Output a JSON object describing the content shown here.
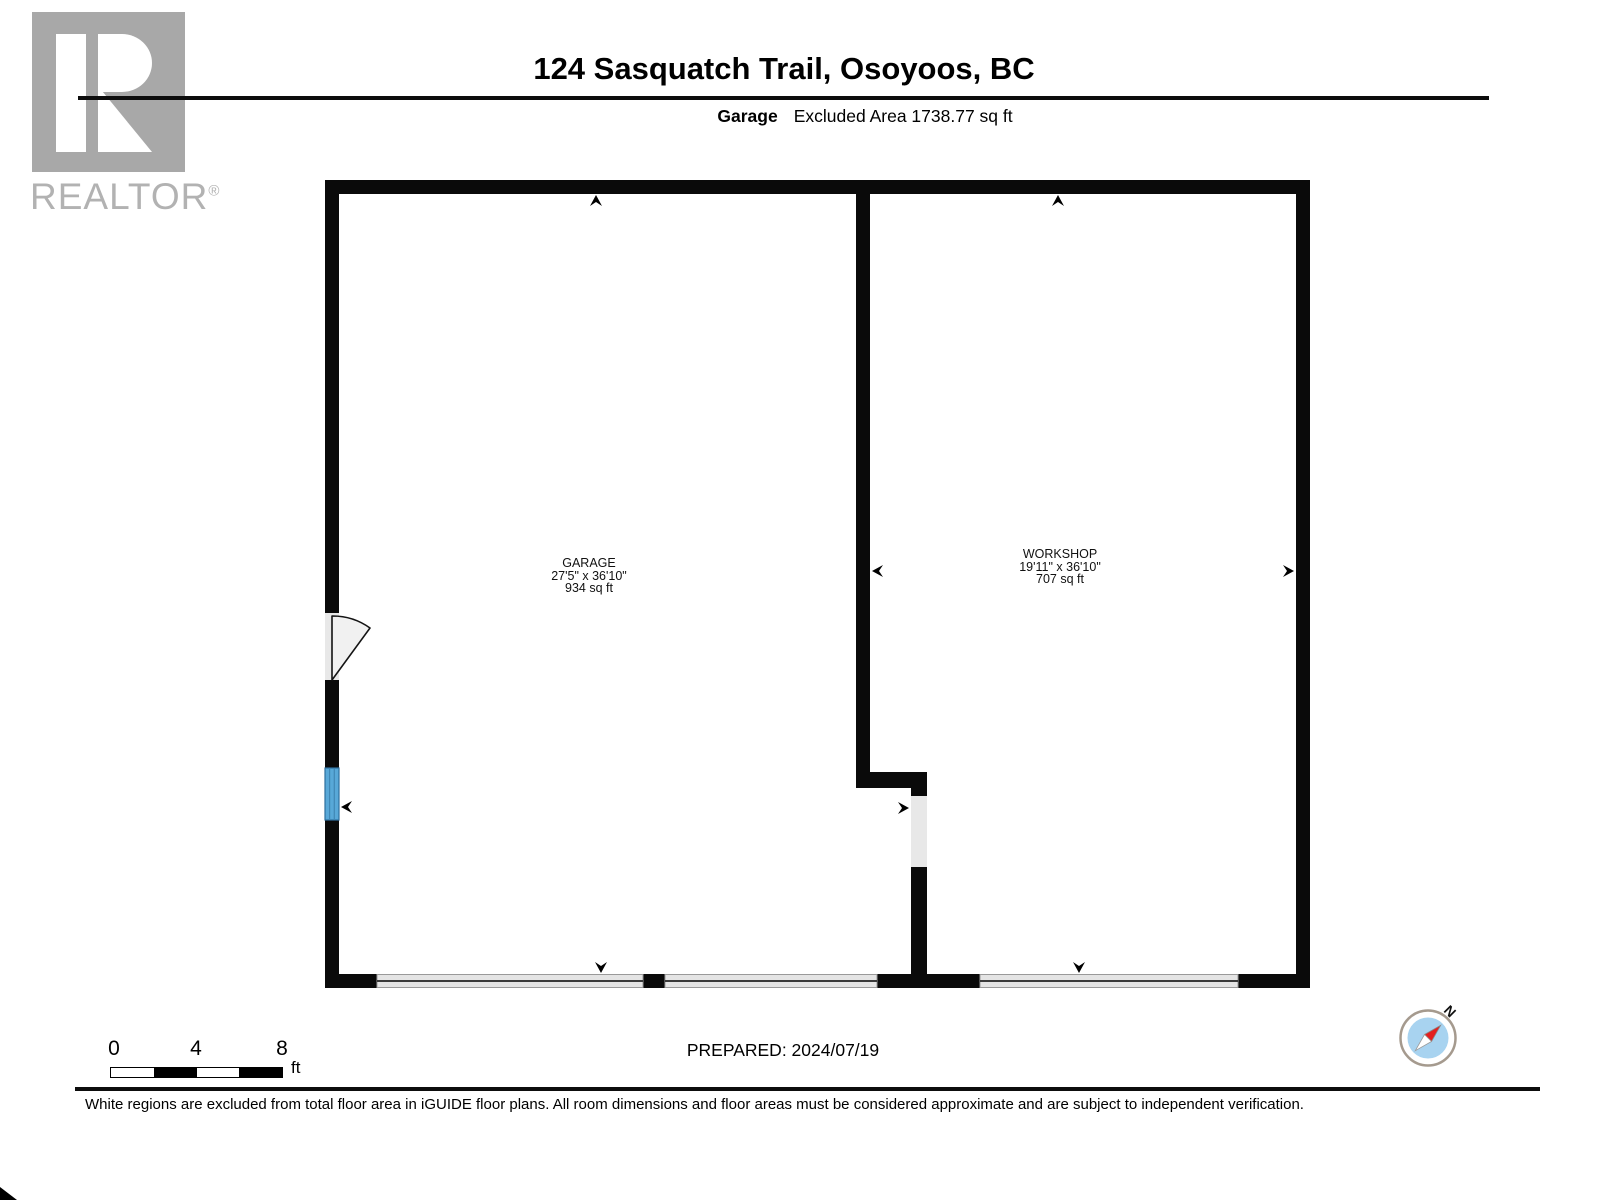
{
  "header": {
    "title": "124 Sasquatch Trail, Osoyoos, BC",
    "floor_label": "Garage",
    "excluded_area": "Excluded Area 1738.77 sq ft",
    "watermark": {
      "word": "REALTOR",
      "registered_mark": "®"
    }
  },
  "floorplan": {
    "rooms": [
      {
        "name": "GARAGE",
        "dimensions": "27'5\" x 36'10\"",
        "area": "934 sq ft"
      },
      {
        "name": "WORKSHOP",
        "dimensions": "19'11\" x 36'10\"",
        "area": "707 sq ft"
      }
    ]
  },
  "footer": {
    "scale": {
      "ticks": [
        "0",
        "4",
        "8"
      ],
      "unit": "ft"
    },
    "prepared": "PREPARED: 2024/07/19",
    "compass": {
      "north_label": "N"
    },
    "disclaimer": "White regions are excluded from total floor area in iGUIDE floor plans. All room dimensions and floor areas must be considered approximate and are subject to independent verification."
  },
  "colors": {
    "wall_black": "#0a0a0a",
    "opening_gray": "#e8e8e8",
    "window_blue": "#58a8d8",
    "compass_face_blue": "#a8d3f0",
    "compass_needle_red": "#e31f1f",
    "watermark_gray": "#a8a8a8"
  }
}
